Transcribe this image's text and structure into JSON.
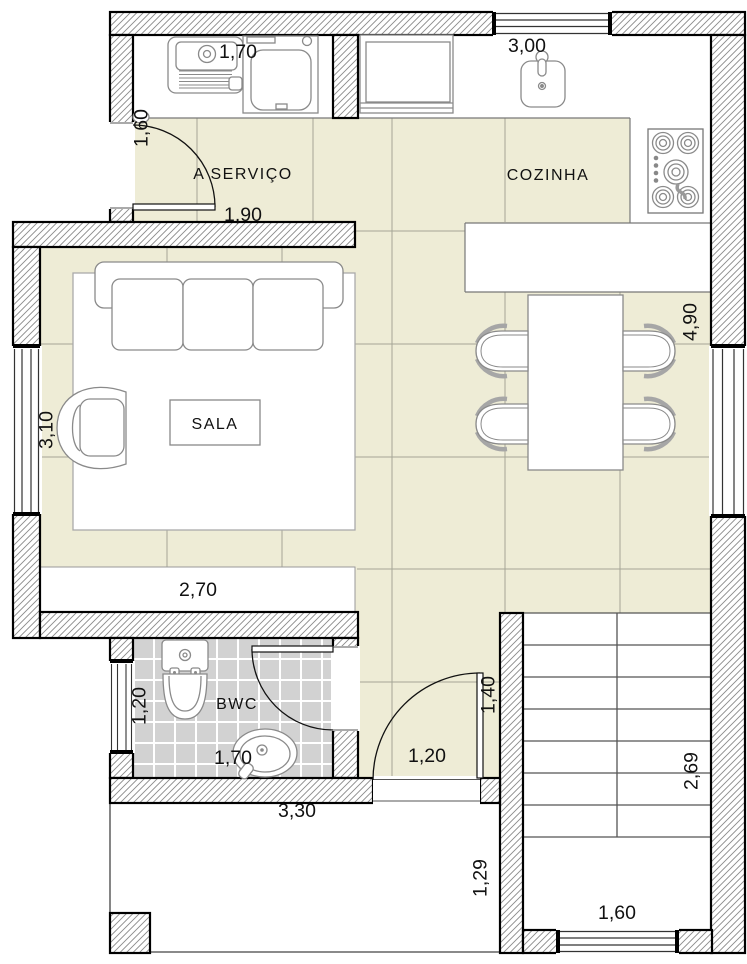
{
  "plan_type": "residential floor plan",
  "rooms": {
    "service": "A SERVIÇO",
    "kitchen": "COZINHA",
    "living": "SALA",
    "bathroom": "BWC"
  },
  "dims": {
    "service_counter": "1,70",
    "kitchen_width": "3,00",
    "service_door": "1,60",
    "service_opening": "1,90",
    "kitchen_depth": "4,90",
    "living_window": "3,10",
    "living_width": "2,70",
    "bathroom_depth": "1,20",
    "bathroom_sink": "1,70",
    "bathroom_width": "3,30",
    "hall_door": "1,20",
    "entry_door": "1,40",
    "stairs_depth": "2,69",
    "porch_depth": "1,29",
    "stairs_width": "1,60"
  },
  "colors": {
    "floor_tile": "#eeecd6",
    "tile_line": "#a5a596",
    "bathroom_tile": "#d2d2d2",
    "wall_hatch": "#8a8a8a",
    "wall_outline": "#000000",
    "furniture_line": "#8a8a8a",
    "text": "#111111"
  }
}
